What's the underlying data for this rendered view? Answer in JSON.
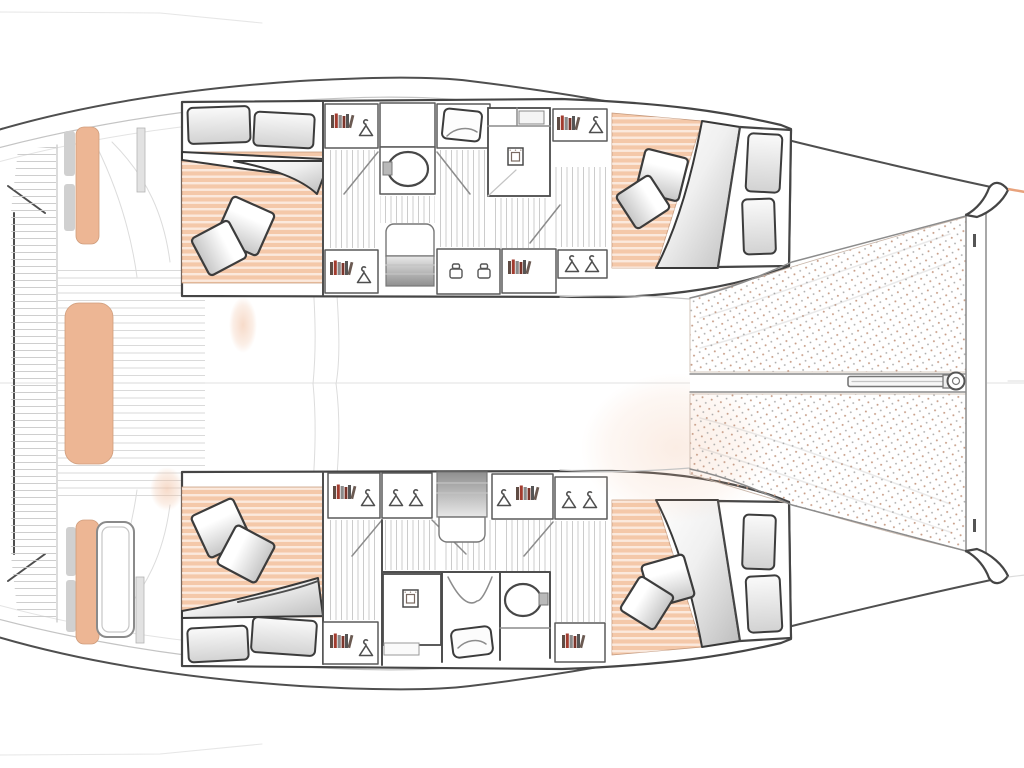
{
  "meta": {
    "title": "Catamaran 4-cabin interior layout plan, top-down view, bow to the right",
    "view": "deck plan",
    "bow_direction": "right"
  },
  "colors": {
    "outline": "#4f4f4f",
    "line_medium": "#8c8c8c",
    "line_light": "#c4c4c4",
    "bed": "#f4c8a9",
    "bed_edge": "#c59a7e",
    "cushion": "#edb694",
    "deck_accent": "#f0bd9d",
    "tramp_dot_warm": "#c79d87",
    "tramp_dot_grey": "#a9a9a9",
    "book_red": "#a23b2e",
    "book_dark": "#5f4c44",
    "accent_tip": "#e8a27c",
    "paper": "#ffffff"
  },
  "plan": {
    "cockpit": {
      "benches": [
        "port-transom-bench",
        "starboard-transom-bench",
        "aft-centre-bench",
        "cockpit-side-bench"
      ],
      "tables": [
        "cockpit-table",
        "side-table"
      ],
      "decking": "teak-strip-platform"
    },
    "port_hull": {
      "position": "top",
      "rooms": [
        {
          "name": "aft-double-cabin",
          "bed": "double",
          "pillows": 2,
          "headboard_cushions": 2
        },
        {
          "name": "bathroom",
          "fixtures": [
            "washbasin",
            "shower",
            "wc-compartment"
          ]
        },
        {
          "name": "companionway",
          "features": [
            "stairs",
            "bookshelves",
            "wardrobes",
            "stools"
          ]
        },
        {
          "name": "forward-double-cabin",
          "bed": "double",
          "pillows": 2,
          "berth_cushions": 2
        }
      ]
    },
    "starboard_hull": {
      "position": "bottom",
      "rooms": [
        {
          "name": "aft-double-cabin",
          "bed": "double",
          "pillows": 2,
          "berth_cushions": 2
        },
        {
          "name": "companionway",
          "features": [
            "stairs",
            "bookshelves",
            "wardrobes"
          ]
        },
        {
          "name": "bathroom",
          "fixtures": [
            "wc-compartment",
            "shower",
            "washbasin"
          ]
        },
        {
          "name": "forward-double-cabin",
          "bed": "double",
          "pillows": 2,
          "berth_cushions": 2
        }
      ]
    },
    "foredeck": {
      "features": [
        "trampoline-port",
        "trampoline-starboard",
        "longitudinal-beam",
        "bowsprit",
        "forward-crossbeam",
        "port-bow",
        "starboard-bow"
      ]
    }
  }
}
